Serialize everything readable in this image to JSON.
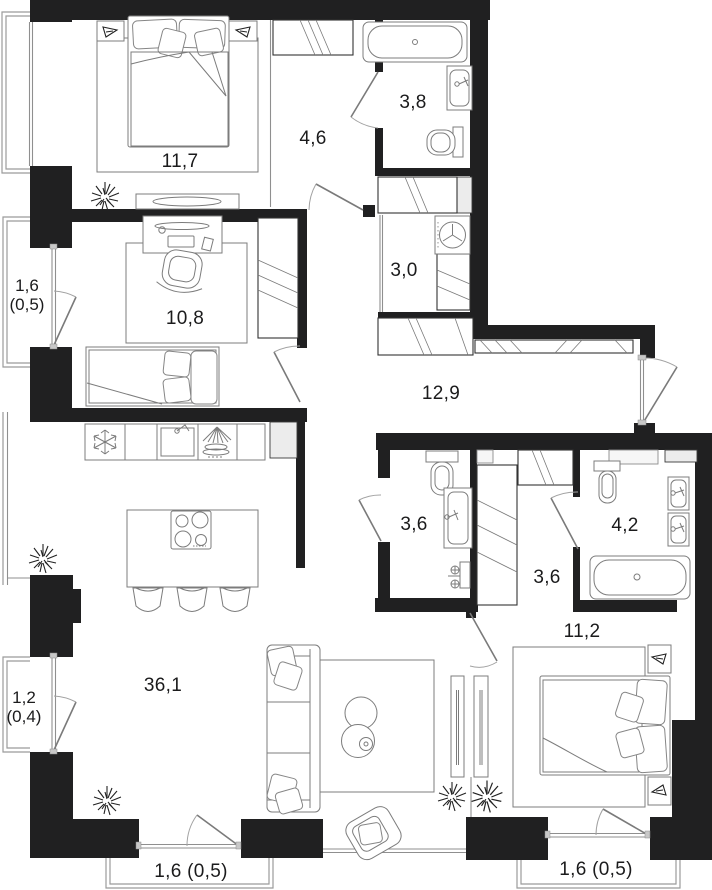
{
  "plan": {
    "type": "apartment-floor-plan",
    "colors": {
      "wall": "#202021",
      "furniture_line": "#7c7c7c",
      "shaft_fill": "#ececec",
      "label_text": "#1b1b1c",
      "background": "#ffffff"
    },
    "rooms": {
      "bedroom_top": {
        "name": "bedroom-top",
        "area": "11,7"
      },
      "hall_top": {
        "name": "corridor-top",
        "area": "4,6"
      },
      "bathroom_top": {
        "name": "bathroom-top",
        "area": "3,8"
      },
      "utility": {
        "name": "utility-laundry",
        "area": "3,0"
      },
      "office": {
        "name": "bedroom-office",
        "area": "10,8"
      },
      "hallway": {
        "name": "entrance-hall",
        "area": "12,9"
      },
      "bathroom_mid": {
        "name": "bathroom-middle",
        "area": "3,6"
      },
      "wardrobe_hall": {
        "name": "wardrobe-corridor",
        "area": "3,6"
      },
      "bathroom_right": {
        "name": "bathroom-right",
        "area": "4,2"
      },
      "bedroom_bottom": {
        "name": "bedroom-bottom",
        "area": "11,2"
      },
      "living": {
        "name": "living-kitchen",
        "area": "36,1"
      }
    },
    "balconies": {
      "left_top": {
        "line1": "1,6",
        "line2": "(0,5)"
      },
      "left_bottom": {
        "line1": "1,2",
        "line2": "(0,4)"
      },
      "bottom_left": {
        "label": "1,6 (0,5)"
      },
      "bottom_right": {
        "label": "1,6 (0,5)"
      }
    }
  }
}
